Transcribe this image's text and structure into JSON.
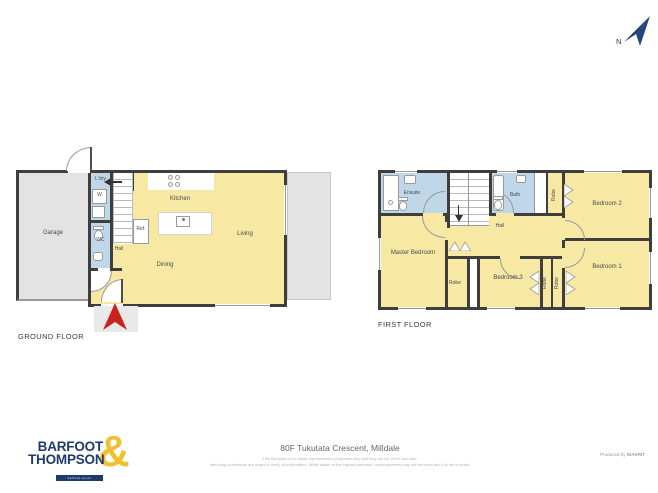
{
  "compass": {
    "label": "N"
  },
  "ground_floor": {
    "title": "GROUND FLOOR",
    "labels": {
      "garage": "Garage",
      "laundry": "L'dry",
      "washer": "W",
      "wc": "WC",
      "hall": "Hall",
      "fridge": "Ref.",
      "kitchen": "Kitchen",
      "dining": "Dining",
      "living": "Living"
    }
  },
  "first_floor": {
    "title": "FIRST FLOOR",
    "labels": {
      "ensuite": "Ensuite",
      "bath": "Bath",
      "robe_bedroom2": "Robe",
      "bedroom2": "Bedroom 2",
      "master_bedroom": "Master Bedroom",
      "hall": "Hall",
      "robe_master": "Robe",
      "bedroom3": "Bedroom 3",
      "robe_bedroom3": "Robe",
      "robe_bedroom1": "Robe",
      "bedroom1": "Bedroom 1"
    }
  },
  "footer": {
    "address": "80F Tukutata Crescent, Milldale",
    "disclaimer_line1": "This floorplan is for visual representation purposes only and may not be 100% accurate.",
    "disclaimer_line2": "Intending purchasers are urged to verify all information. While drawn to the highest standard, measurements may not be exact and it is not to scale.",
    "produced_by": "Produced by ",
    "producer": "DIAKRIT",
    "brand_line1": "BARFOOT",
    "brand_line2": "THOMPSON",
    "brand_amp": "&",
    "brand_site": "barfoot.co.nz"
  },
  "colors": {
    "room_yellow": "#F7E9A4",
    "wet_area_blue": "#BFD7E8",
    "garage_grey": "#E3E3E3",
    "wall": "#3E3E3E",
    "entry_arrow_red": "#C8231C",
    "brand_navy": "#1E3A6E",
    "brand_gold": "#F0C030"
  }
}
